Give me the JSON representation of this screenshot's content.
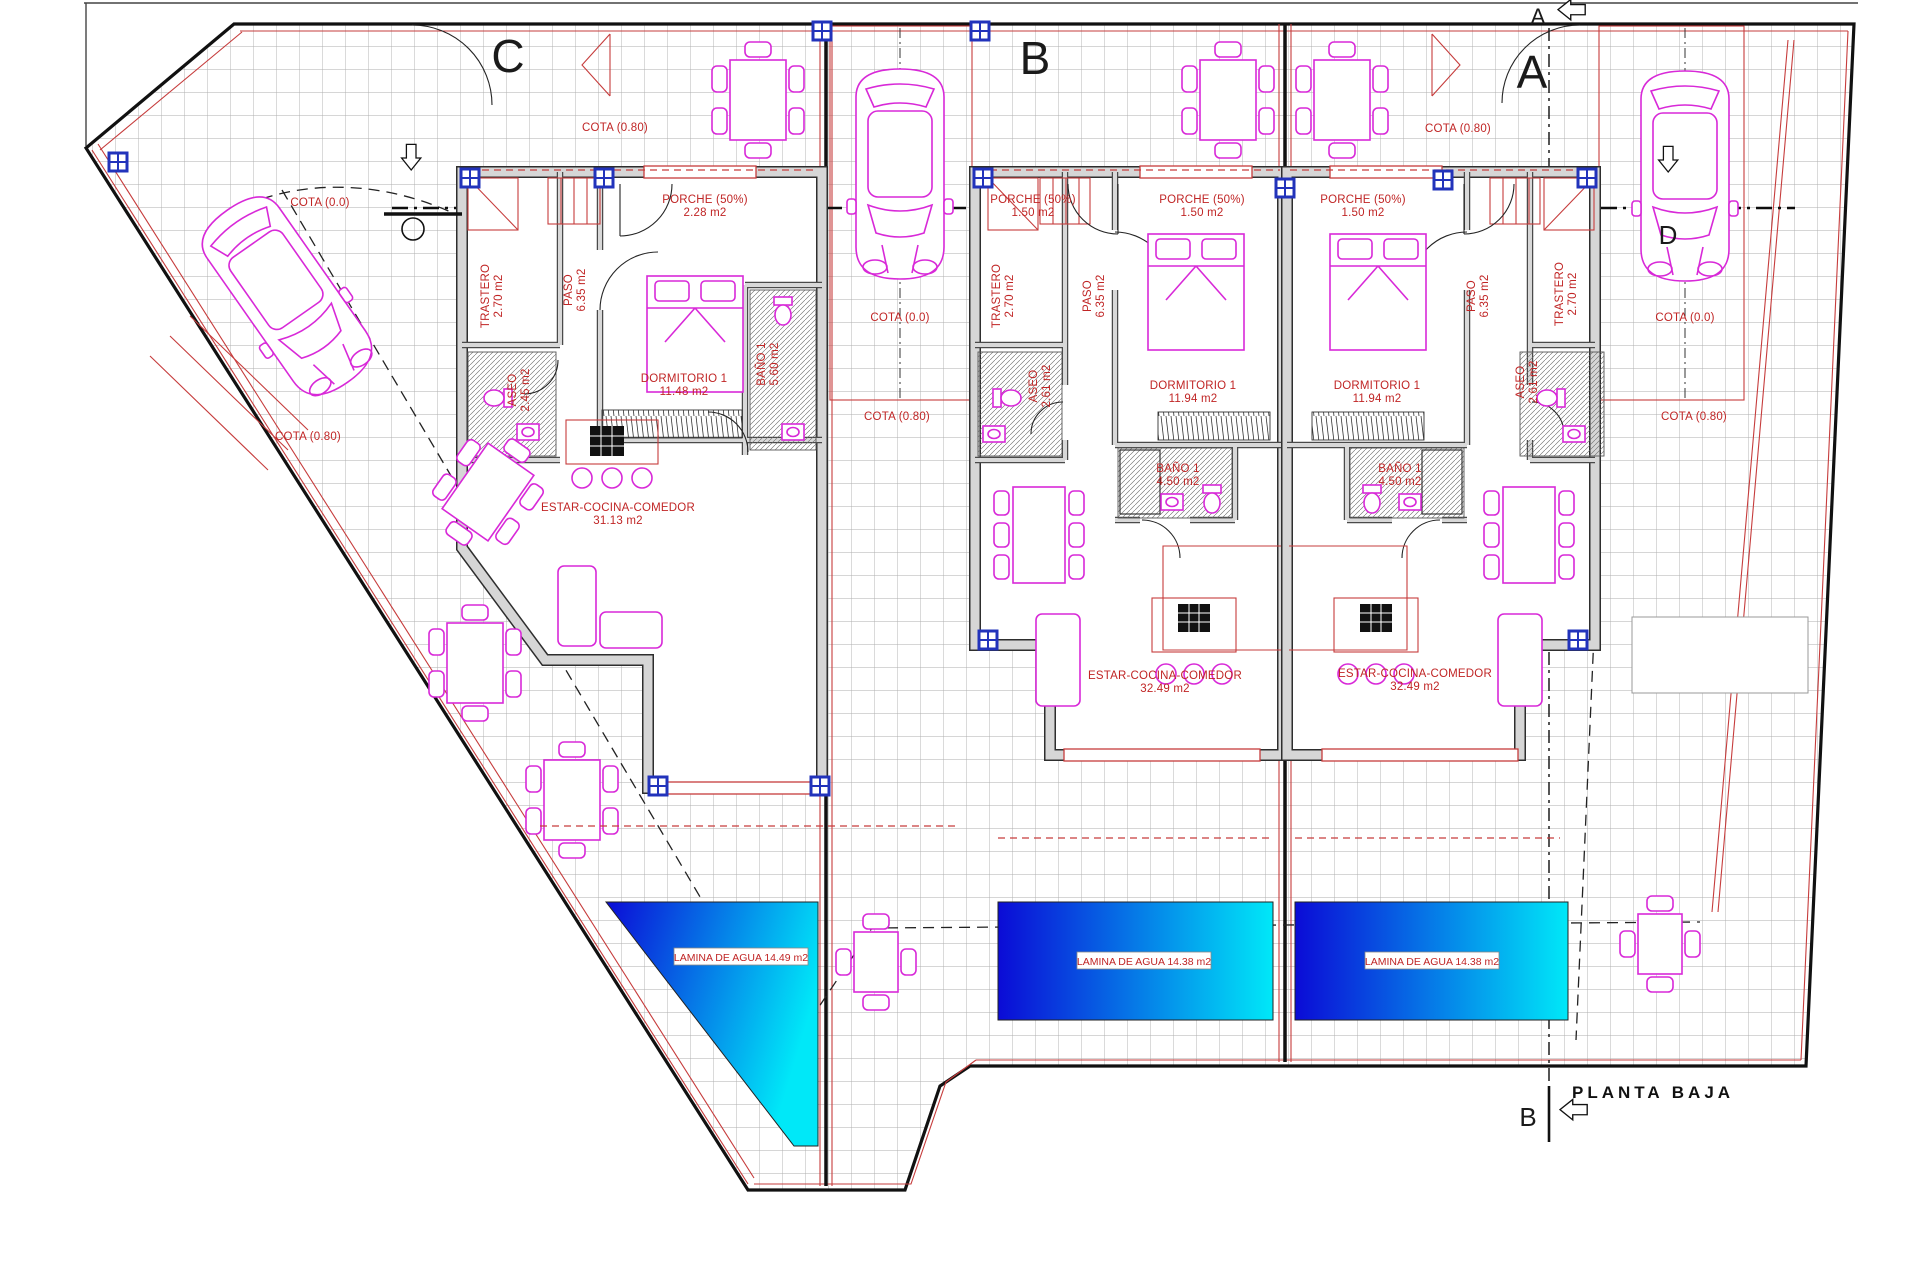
{
  "title": "PLANTA BAJA",
  "markers": {
    "a": "A",
    "b": "B",
    "c": "C",
    "d": "D"
  },
  "site": {
    "cota_0": "COTA (0.0)",
    "cota_80": "COTA (0.80)"
  },
  "porche": {
    "name": "PORCHE (50%)",
    "area_left": "2.28 m2",
    "area": "1.50 m2"
  },
  "pools": {
    "left": "LAMINA DE AGUA 14.49 m2",
    "middle": "LAMINA DE AGUA 14.38 m2",
    "right": "LAMINA DE AGUA 14.38 m2"
  },
  "rooms": {
    "trastero": {
      "name": "TRASTERO",
      "area": "2.70 m2"
    },
    "paso": {
      "name": "PASO",
      "area": "6.35 m2"
    },
    "aseo_left": {
      "name": "ASEO",
      "area": "2.45 m2"
    },
    "aseo": {
      "name": "ASEO",
      "area": "2.61 m2"
    },
    "dorm_left": {
      "name": "DORMITORIO 1",
      "area": "11.48 m2"
    },
    "dorm": {
      "name": "DORMITORIO 1",
      "area": "11.94 m2"
    },
    "bano_left": {
      "name": "BAÑO 1",
      "area": "5.60 m2"
    },
    "bano": {
      "name": "BAÑO 1",
      "area": "4.50 m2"
    },
    "estar_left": {
      "name": "ESTAR-COCINA-COMEDOR",
      "area": "31.13 m2"
    },
    "estar": {
      "name": "ESTAR-COCINA-COMEDOR",
      "area": "32.49 m2"
    }
  },
  "colors": {
    "accent_red": "#c63c3c",
    "furniture_magenta": "#d829d8",
    "pool_dark": "#0b0bd6",
    "pool_light": "#00e8f8",
    "wall_gray": "#d6d6d6",
    "node_blue": "#2233bb"
  }
}
